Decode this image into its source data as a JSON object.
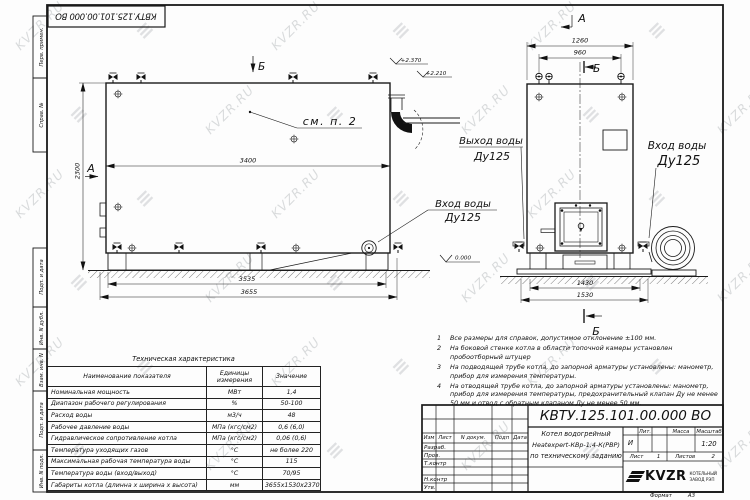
{
  "colors": {
    "line": "#1a1a1a",
    "watermark": "#c0c4c7"
  },
  "watermark": {
    "text": "KVZR.RU",
    "glyph": "≡"
  },
  "sheet": {
    "stamp": "КВТУ.125.101.00.000  ВО",
    "format_label": "Формат",
    "format_value": "А3"
  },
  "margin_labels": {
    "top1": "Перв. примен.",
    "top2": "Справ. №",
    "b1": "Подп. и дата",
    "b2": "Инв. N дубл.",
    "b3": "Взам. инв. N",
    "b4": "Подп. и дата",
    "b5": "Инв. N подл."
  },
  "views": {
    "side": {
      "dim_width_top": "3400",
      "dim_height": "2300",
      "dim_base": "3535",
      "dim_overall": "3655",
      "marker_a": "А",
      "marker_b": "Б",
      "note_ref": "см. п. 2",
      "level_top1": "+2.370",
      "level_top2": "+2.210",
      "level_zero": "0.000",
      "inlet_line1": "Вход воды",
      "inlet_line2": "Ду125"
    },
    "front": {
      "marker_a": "А",
      "marker_b_top": "Б",
      "marker_b_bottom": "Б",
      "dim_top_outer": "1260",
      "dim_top_inner": "960",
      "dim_bottom_inner": "1430",
      "dim_bottom_outer": "1530",
      "outlet_line1": "Выход воды",
      "outlet_line2": "Ду125",
      "inlet_line1": "Вход воды",
      "inlet_line2": "Ду125"
    }
  },
  "tech_table": {
    "title": "Техническая характеристика",
    "col_name": "Наименование показателя",
    "col_units": "Единицы измерения",
    "col_value": "Значение",
    "rows": [
      {
        "name": "Номинальная мощность",
        "units": "МВт",
        "value": "1,4"
      },
      {
        "name": "Диапазон рабочего регулирования",
        "units": "%",
        "value": "50-100"
      },
      {
        "name": "Расход воды",
        "units": "м3/ч",
        "value": "48"
      },
      {
        "name": "Рабочее давление воды",
        "units": "МПа (кгс/см2)",
        "value": "0,6 (6,0)"
      },
      {
        "name": "Гидравлическое сопротивление котла",
        "units": "МПа (кгс/см2)",
        "value": "0,06 (0,6)"
      },
      {
        "name": "Температура уходящих газов",
        "units": "°С",
        "value": "не более 220"
      },
      {
        "name": "Максимальная рабочая температура воды",
        "units": "°С",
        "value": "115"
      },
      {
        "name": "Температура воды (вход/выход)",
        "units": "°С",
        "value": "70/95"
      },
      {
        "name": "Габариты котла (длинна х ширина х высота)",
        "units": "мм",
        "value": "3655х1530х2370"
      }
    ]
  },
  "notes": [
    {
      "num": "1",
      "text": "Все размеры для справок, допустимое отклонение ±100 мм."
    },
    {
      "num": "2",
      "text": "На боковой стенке котла в области топочной камеры установлен пробоотборный штуцер"
    },
    {
      "num": "3",
      "text": "На  подводящей трубе котла, до запорной арматуры установлены: манометр, прибор для измерения температуры."
    },
    {
      "num": "4",
      "text": "На отводящей трубе котла, до запорной арматуры установлены: манометр, прибор для измерения температуры, предохранительный клапан Ду не менее 50 мм и отвод с обратным клапаном Ду не менее 50 мм."
    }
  ],
  "title_block": {
    "designation": "КВТУ.125.101.00.000  ВО",
    "doc_name_line1": "Котел водогрейный",
    "doc_name_line2": "Heatexpert-КВр-1,4-К(РВР)",
    "doc_name_line3": "по техническому заданию",
    "headers": {
      "izm": "Изм",
      "list": "Лист",
      "doc": "N докум.",
      "podp": "Подп",
      "data": "Дата",
      "lit": "Лит.",
      "massa": "Масса",
      "masshtab": "Масштаб"
    },
    "rows": {
      "razrab": "Разраб.",
      "prov": "Пров.",
      "tkontr": "Т.контр",
      "nkontr": "Н.контр",
      "utv": "Утв."
    },
    "lit_value": "И",
    "scale": "1:20",
    "sheet_label": "Лист",
    "sheet_value": "1",
    "sheets_label": "Листов",
    "sheets_value": "2",
    "logo_text": "KVZR",
    "logo_sub1": "КОТЕЛЬНЫЙ",
    "logo_sub2": "ЗАВОД РЭП",
    "format_label": "Формат",
    "format_value": "А3"
  }
}
